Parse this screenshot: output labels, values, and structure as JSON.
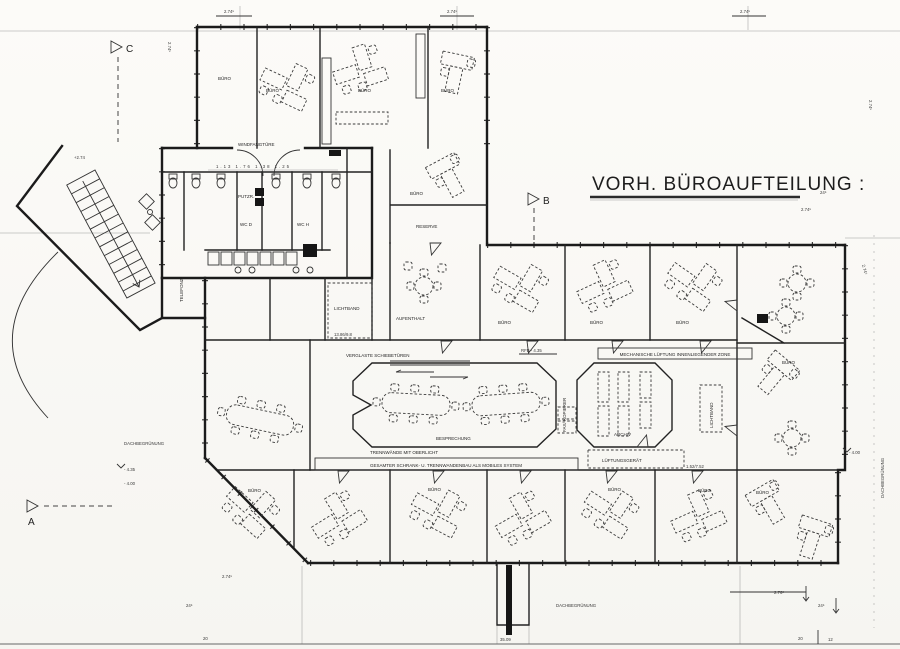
{
  "title": "VORH. BÜROAUFTEILUNG :",
  "markers": {
    "a": "A",
    "b": "B",
    "c": "C"
  },
  "rooms": {
    "buero": "BÜRO",
    "reserve": "RESERVE",
    "aufenthalt": "AUFENTHALT",
    "archiv": "ARCHIV",
    "besprechung": "BESPRECHUNG",
    "fax_kopierer": "FAX/ KOPIERER",
    "lichtband": "LICHTBAND",
    "lueftungsgeraet": "LÜFTUNGSGERÄT",
    "wc_d": "WC D",
    "wc_h": "WC H",
    "putzraum": "PUTZR.",
    "telefon": "TELEFONZ.",
    "windfangtuere": "WINDFANGTÜRE"
  },
  "annotations": {
    "verglaste_schiebetueren": "VERGLASTE SCHIEBETÜREN",
    "trennwaende_oberlicht": "TRENNWÄNDE MIT OBERLICHT",
    "mobiles_system": "GESAMTER SCHRANK- U. TRENNWANDENBAU ALS MOBILES SYSTEM",
    "mech_lueftung": "MECHANISCHE LÜFTUNG INNENLIEGENDER ZONE",
    "rfb": "RFB - 4.35",
    "dachbegruenung": "DACHBEGRÜNUNG"
  },
  "levels": {
    "plus_274": "+2.74",
    "minus_435": "- 4.35",
    "minus_400": "- 4.00"
  },
  "dimensions": {
    "d274": "2.74⁵",
    "d276": "2.76⁵",
    "d24": "24⁵",
    "bottom_20": "20",
    "bottom_3509": "35.09",
    "bottom_12": "12",
    "wc_dims": "1.13   1.76   1.38   1.25",
    "lichtband_dim": "13.86/9.8",
    "lueftung_dim": "1.52/7.52"
  }
}
